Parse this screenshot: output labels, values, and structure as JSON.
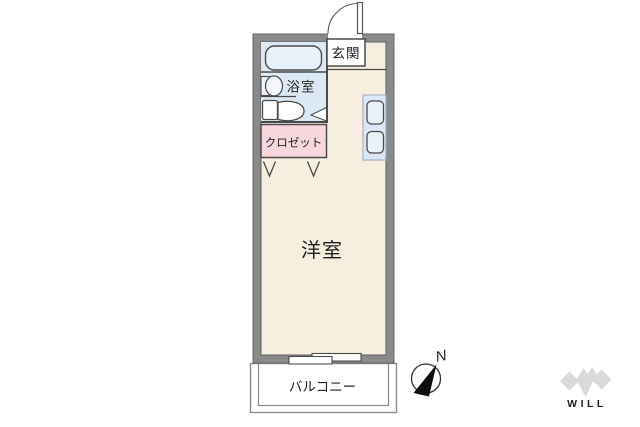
{
  "floorplan": {
    "rooms": {
      "genkan": {
        "label": "玄関"
      },
      "bathroom": {
        "label": "浴室"
      },
      "closet": {
        "label": "クロゼット"
      },
      "main_room": {
        "label": "洋室"
      },
      "balcony": {
        "label": "バルコニー"
      }
    },
    "fixtures": [
      "bathtub-icon",
      "washbasin-icon",
      "toilet-icon",
      "kitchen-counter-icon",
      "entrance-door-swing-icon",
      "bathroom-door-icon",
      "closet-folding-door-icon",
      "sliding-window-icon"
    ],
    "colors": {
      "wall": "#8a8a8a",
      "floor": "#f6efe0",
      "bathroom": "#dce9f4",
      "closet": "#f7d7dd",
      "fixture_fill": "#e9f1fa",
      "outline": "#4a4a4a",
      "balcony_line": "#8a8a8a"
    }
  },
  "compass": {
    "north_label": "N"
  },
  "logo": {
    "text": "WILL",
    "color": "#d0d0d0"
  }
}
